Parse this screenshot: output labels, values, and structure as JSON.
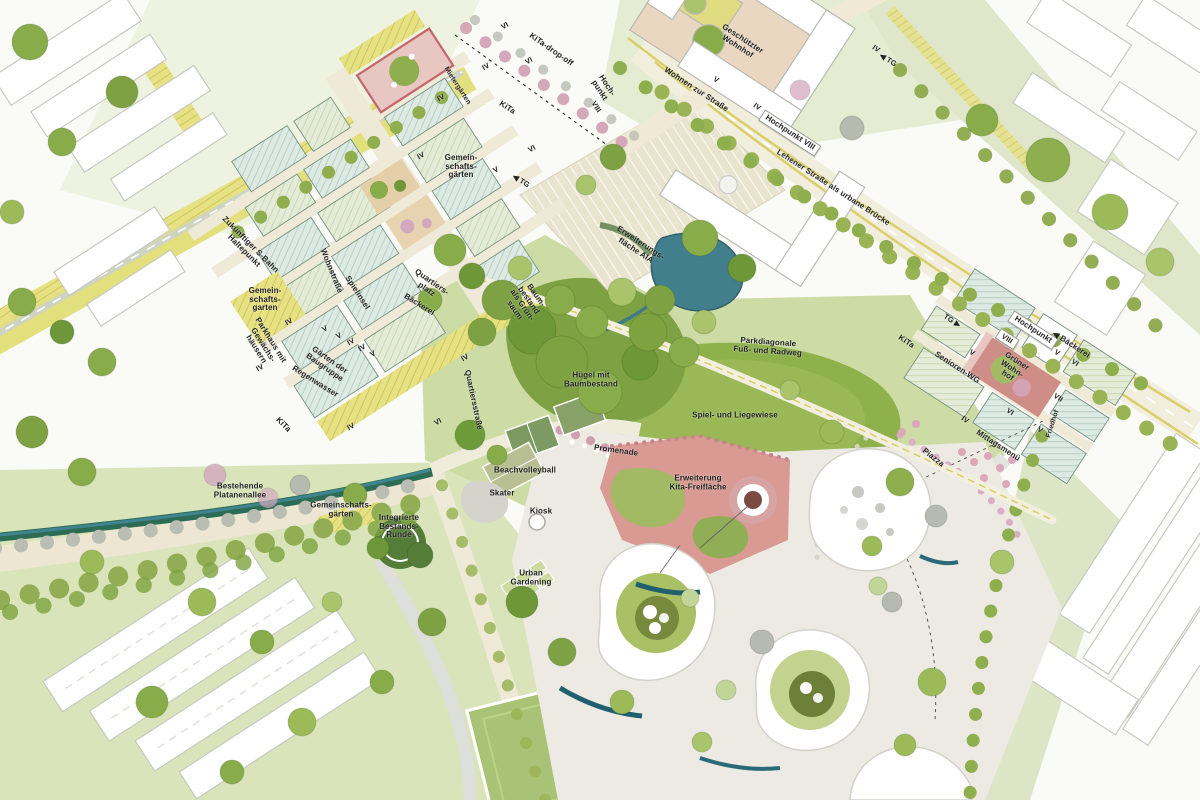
{
  "map": {
    "title_hidden": "",
    "colors": {
      "street_cream": "#f0ead8",
      "rail_yellow": "#e5e07b",
      "roof_bluegreen": "#dde9e3",
      "roof_hatch": "#b5cdc2",
      "roof_green": "#e3ead6",
      "park_light": "#ccdca4",
      "meadow": "#8fb14c",
      "tree_dark": "#6d9738",
      "tree_mid": "#88ac4a",
      "tree_gray": "#b6bab0",
      "tree_pink": "#d3a8bf",
      "water_teal": "#3d7f8c",
      "play_red": "#c4666b",
      "kita_salmon": "#d89a92",
      "paved": "#eceae2",
      "context_white": "#ffffff",
      "text": "#232323"
    },
    "labels": [
      {
        "t": "KiTa-drop-off",
        "x": 551,
        "y": 50,
        "r": 35
      },
      {
        "t": "Mietergärten",
        "x": 457,
        "y": 86,
        "r": 57,
        "s": 7
      },
      {
        "t": "Hoch-\npunkt",
        "x": 603,
        "y": 88,
        "r": 57
      },
      {
        "t": "VIII",
        "x": 596,
        "y": 107,
        "r": 57,
        "s": 7.5
      },
      {
        "t": "KiTa",
        "x": 507,
        "y": 108,
        "r": 33
      },
      {
        "t": "◀ TG",
        "x": 521,
        "y": 181,
        "r": 33,
        "s": 7.5
      },
      {
        "t": "Gemein-\nschafts-\ngärten",
        "x": 461,
        "y": 167,
        "r": 0
      },
      {
        "t": "Geschützter\nWohnhof",
        "x": 740,
        "y": 43,
        "r": 33
      },
      {
        "t": "Wohnen zur Straße",
        "x": 696,
        "y": 90,
        "r": 33
      },
      {
        "t": "V",
        "x": 716,
        "y": 80,
        "r": 33,
        "s": 7.5
      },
      {
        "t": "IV",
        "x": 757,
        "y": 107,
        "r": 33,
        "s": 7.5
      },
      {
        "t": "IV",
        "x": 876,
        "y": 49,
        "r": 33,
        "s": 7.5
      },
      {
        "t": "◀ TG",
        "x": 888,
        "y": 60,
        "r": 33,
        "s": 7.5
      },
      {
        "t": "Hochpunkt VIII",
        "x": 790,
        "y": 133,
        "r": 33,
        "bg": 1
      },
      {
        "t": "Lehener Straße als urbane Brücke",
        "x": 833,
        "y": 188,
        "r": 33
      },
      {
        "t": "Zukünftiger S-Bahn\nHaltepunkt",
        "x": 247,
        "y": 248,
        "r": 45
      },
      {
        "t": "Gemein-\nschafts-\ngarten",
        "x": 265,
        "y": 300,
        "r": 0
      },
      {
        "t": "Parkhaus mit\nGewächs-\nhäusern",
        "x": 263,
        "y": 345,
        "r": 58
      },
      {
        "t": "Gärten der\nBaugruppe",
        "x": 327,
        "y": 364,
        "r": 35
      },
      {
        "t": "Regenwasser",
        "x": 315,
        "y": 382,
        "r": 32
      },
      {
        "t": "KiTa",
        "x": 283,
        "y": 425,
        "r": 45
      },
      {
        "t": "Wohnstraße",
        "x": 331,
        "y": 271,
        "r": 68
      },
      {
        "t": "Spielinsel",
        "x": 357,
        "y": 293,
        "r": 57
      },
      {
        "t": "Quartiers-\nplatz",
        "x": 429,
        "y": 286,
        "r": 35
      },
      {
        "t": "Bäckerei",
        "x": 419,
        "y": 305,
        "r": 32
      },
      {
        "t": "Quartiersstraße",
        "x": 473,
        "y": 400,
        "r": 78
      },
      {
        "t": "Erweiterungs-\nfläche AIA",
        "x": 638,
        "y": 247,
        "r": 33
      },
      {
        "t": "Baum-\nbestand\nals Grün-\nsaum",
        "x": 525,
        "y": 303,
        "r": 55
      },
      {
        "t": "Hügel mit\nBaumbestand",
        "x": 591,
        "y": 380,
        "r": 0
      },
      {
        "t": "Parkdiagonale\nFuß- und Radweg",
        "x": 768,
        "y": 347,
        "r": 4
      },
      {
        "t": "Spiel- und Liegewiese",
        "x": 735,
        "y": 416,
        "r": 0
      },
      {
        "t": "Promenade",
        "x": 616,
        "y": 451,
        "r": 8
      },
      {
        "t": "Beachvolleyball",
        "x": 525,
        "y": 471,
        "r": 0
      },
      {
        "t": "Skater",
        "x": 502,
        "y": 494,
        "r": 0
      },
      {
        "t": "Kiosk",
        "x": 541,
        "y": 512,
        "r": 0
      },
      {
        "t": "Erweiterung\nKita-Freifläche",
        "x": 698,
        "y": 483,
        "r": 0
      },
      {
        "t": "Bestehende\nPlatanenallee",
        "x": 240,
        "y": 491,
        "r": 0
      },
      {
        "t": "Gemeinschafts-\ngärten",
        "x": 341,
        "y": 510,
        "r": 0
      },
      {
        "t": "Integrierte\nBestands-\nRunde",
        "x": 399,
        "y": 527,
        "r": 0
      },
      {
        "t": "Urban\nGardening",
        "x": 531,
        "y": 578,
        "r": 0
      },
      {
        "t": "TG ▶",
        "x": 952,
        "y": 321,
        "r": 33,
        "s": 7.5
      },
      {
        "t": "KiTa",
        "x": 906,
        "y": 342,
        "r": 33
      },
      {
        "t": "Senioren-WG",
        "x": 957,
        "y": 368,
        "r": 33
      },
      {
        "t": "VIII",
        "x": 1007,
        "y": 339,
        "r": 33,
        "bg": 1,
        "s": 7.5
      },
      {
        "t": "Hochpunkt",
        "x": 1033,
        "y": 330,
        "r": 33,
        "bg": 1
      },
      {
        "t": "◀ Bäckerei",
        "x": 1071,
        "y": 345,
        "r": 33
      },
      {
        "t": "Grüner\nWohn-\nhof",
        "x": 1012,
        "y": 369,
        "r": 33
      },
      {
        "t": "Mittagsmenü",
        "x": 998,
        "y": 446,
        "r": 33
      },
      {
        "t": "Piazza",
        "x": 933,
        "y": 458,
        "r": 38
      },
      {
        "t": "Friedhof",
        "x": 1053,
        "y": 424,
        "r": -72,
        "s": 7
      },
      {
        "t": "VI",
        "x": 505,
        "y": 26,
        "r": -30,
        "s": 7.5
      },
      {
        "t": "VI",
        "x": 529,
        "y": 61,
        "r": -30,
        "s": 7.5
      },
      {
        "t": "IV",
        "x": 486,
        "y": 67,
        "r": -30,
        "s": 7.5
      },
      {
        "t": "IV",
        "x": 441,
        "y": 98,
        "r": -30,
        "s": 7.5
      },
      {
        "t": "IV",
        "x": 421,
        "y": 156,
        "r": -30,
        "s": 7.5
      },
      {
        "t": "VI",
        "x": 532,
        "y": 149,
        "r": -30,
        "s": 7.5
      },
      {
        "t": "V",
        "x": 496,
        "y": 170,
        "r": -30,
        "s": 7.5
      },
      {
        "t": "IV",
        "x": 289,
        "y": 322,
        "r": -30,
        "s": 7.5
      },
      {
        "t": "V",
        "x": 325,
        "y": 329,
        "r": -30,
        "s": 7.5
      },
      {
        "t": "V",
        "x": 339,
        "y": 336,
        "r": -30,
        "s": 7.5
      },
      {
        "t": "IV",
        "x": 351,
        "y": 342,
        "r": -30,
        "s": 7.5
      },
      {
        "t": "IV",
        "x": 362,
        "y": 348,
        "r": -30,
        "s": 7.5
      },
      {
        "t": "V",
        "x": 373,
        "y": 354,
        "r": -30,
        "s": 7.5
      },
      {
        "t": "IV",
        "x": 260,
        "y": 368,
        "r": -30,
        "s": 7.5
      },
      {
        "t": "IV",
        "x": 465,
        "y": 358,
        "r": -30,
        "s": 7.5
      },
      {
        "t": "IV",
        "x": 351,
        "y": 427,
        "r": -30,
        "s": 7.5
      },
      {
        "t": "VI",
        "x": 438,
        "y": 422,
        "r": -30,
        "s": 7.5
      },
      {
        "t": "V",
        "x": 972,
        "y": 353,
        "r": 33,
        "s": 7.5
      },
      {
        "t": "V",
        "x": 1057,
        "y": 353,
        "r": 33,
        "s": 7.5
      },
      {
        "t": "VI",
        "x": 1075,
        "y": 363,
        "r": 33,
        "s": 7.5
      },
      {
        "t": "VII",
        "x": 1058,
        "y": 398,
        "r": 33,
        "s": 7.5
      },
      {
        "t": "VI",
        "x": 1010,
        "y": 412,
        "r": 33,
        "s": 7.5
      },
      {
        "t": "V",
        "x": 1040,
        "y": 430,
        "r": 33,
        "s": 7.5
      },
      {
        "t": "IV",
        "x": 965,
        "y": 420,
        "r": 33,
        "s": 7.5
      }
    ]
  }
}
